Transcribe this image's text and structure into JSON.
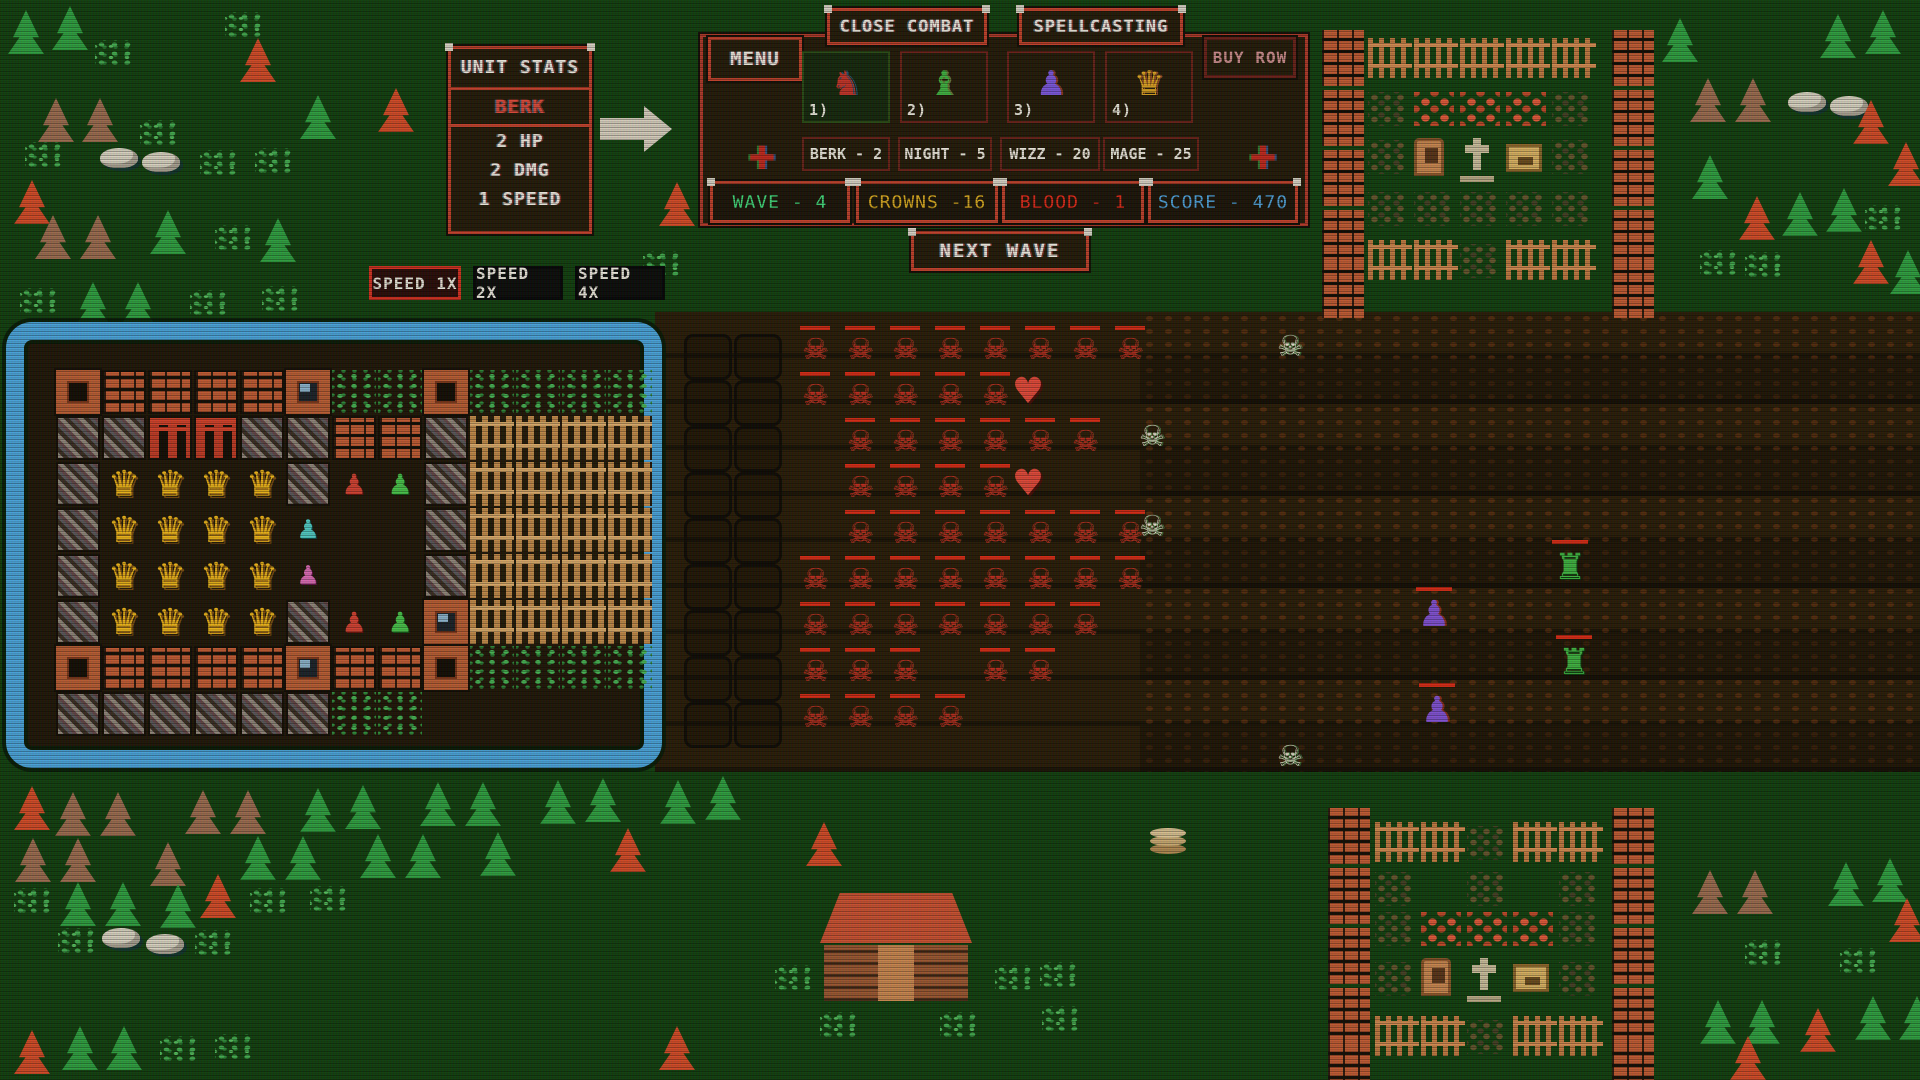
{
  "hud": {
    "unit_stats": {
      "title": "UNIT STATS",
      "unit_name": "BERK",
      "lines": [
        "2 HP",
        "2 DMG",
        "1 SPEED"
      ]
    },
    "menu_label": "MENU",
    "close_combat_label": "CLOSE COMBAT",
    "spellcasting_label": "SPELLCASTING",
    "buy_row_label": "BUY ROW",
    "slots": [
      {
        "num": "1)",
        "unit": "berk",
        "glyph": "♞"
      },
      {
        "num": "2)",
        "unit": "night",
        "glyph": "♝"
      },
      {
        "num": "3)",
        "unit": "wizz",
        "glyph": "♟"
      },
      {
        "num": "4)",
        "unit": "mage",
        "glyph": "♛"
      }
    ],
    "costs": [
      "BERK - 2",
      "NIGHT - 5",
      "WIZZ - 20",
      "MAGE - 25"
    ],
    "stats": [
      {
        "label": "WAVE - 4",
        "color": "#42d87a"
      },
      {
        "label": "CROWNS -16",
        "color": "#d8a81f"
      },
      {
        "label": "BLOOD - 1",
        "color": "#e02818"
      },
      {
        "label": "SCORE - 470",
        "color": "#4fa0d8"
      }
    ],
    "next_wave_label": "NEXT WAVE",
    "speed_buttons": [
      {
        "label": "SPEED 1X",
        "active": true
      },
      {
        "label": "SPEED 2X",
        "active": false
      },
      {
        "label": "SPEED 4X",
        "active": false
      }
    ],
    "deco_cross": "✚"
  },
  "colors": {
    "accent_red": "#c0402a",
    "fort_blue": "#4aa2d8",
    "bg_green": "#123f0e",
    "field_brown": "#241906"
  },
  "sprite_glyphs": {
    "skel-red": "☠",
    "skel-white": "☠",
    "heart": "♥",
    "robot": "♜",
    "octo": "♟"
  },
  "fort_glyphs": {
    "C": "♛",
    "r": "♟",
    "n": "♟",
    "c": "♟",
    "p": "♟"
  },
  "map": {
    "fort": {
      "x0": 38,
      "y0": 352,
      "cell": 46,
      "rows": [
        "TWWWWSggTgggg",
        "MMGGMMWWMFFFF",
        "MCCCCMrnMFFFF",
        "MCCCCc..MFFFF",
        "MCCCCp..MFFFF",
        "MCCCCMrnSFFFF",
        "TWWWWSWWTgggg",
        "MMMMMMgg....."
      ]
    },
    "grids": [
      {
        "t": "slotcell",
        "x0": 684,
        "y0": 334,
        "dx": 50,
        "dy": 46,
        "rows": [
          "11",
          "11",
          "11",
          "11",
          "11",
          "11",
          "11",
          "11",
          "11"
        ]
      },
      {
        "t": "skel-red",
        "x0": 795,
        "y0": 328,
        "dx": 45,
        "dy": 46,
        "rows": [
          "11111111",
          "11111000",
          "01111110",
          "01111000",
          "01111111",
          "11111111",
          "11111110",
          "11101100",
          "11110000"
        ]
      }
    ],
    "sprites": [
      {
        "t": "tree-green",
        "x": 8,
        "y": 10
      },
      {
        "t": "tree-green",
        "x": 52,
        "y": 6
      },
      {
        "t": "grass",
        "x": 95,
        "y": 40
      },
      {
        "t": "grass",
        "x": 225,
        "y": 12
      },
      {
        "t": "tree-red",
        "x": 240,
        "y": 38
      },
      {
        "t": "tree-brown",
        "x": 38,
        "y": 98
      },
      {
        "t": "tree-brown",
        "x": 82,
        "y": 98
      },
      {
        "t": "grass",
        "x": 140,
        "y": 120
      },
      {
        "t": "grass",
        "x": 25,
        "y": 142
      },
      {
        "t": "rock",
        "x": 100,
        "y": 148
      },
      {
        "t": "rock",
        "x": 142,
        "y": 152
      },
      {
        "t": "grass",
        "x": 200,
        "y": 150
      },
      {
        "t": "grass",
        "x": 255,
        "y": 148
      },
      {
        "t": "tree-red",
        "x": 378,
        "y": 88
      },
      {
        "t": "tree-green",
        "x": 300,
        "y": 95
      },
      {
        "t": "tree-red",
        "x": 14,
        "y": 180
      },
      {
        "t": "tree-brown",
        "x": 35,
        "y": 215
      },
      {
        "t": "tree-brown",
        "x": 80,
        "y": 215
      },
      {
        "t": "tree-green",
        "x": 150,
        "y": 210
      },
      {
        "t": "grass",
        "x": 215,
        "y": 225
      },
      {
        "t": "tree-green",
        "x": 260,
        "y": 218
      },
      {
        "t": "grass",
        "x": 20,
        "y": 288
      },
      {
        "t": "tree-green",
        "x": 75,
        "y": 282
      },
      {
        "t": "tree-green",
        "x": 120,
        "y": 282
      },
      {
        "t": "grass",
        "x": 190,
        "y": 290
      },
      {
        "t": "grass",
        "x": 262,
        "y": 286
      },
      {
        "t": "tree-red",
        "x": 659,
        "y": 182
      },
      {
        "t": "grass",
        "x": 643,
        "y": 251
      },
      {
        "t": "tree-green",
        "x": 1662,
        "y": 18
      },
      {
        "t": "tree-green",
        "x": 1820,
        "y": 14
      },
      {
        "t": "tree-green",
        "x": 1865,
        "y": 10
      },
      {
        "t": "tree-brown",
        "x": 1690,
        "y": 78
      },
      {
        "t": "tree-brown",
        "x": 1735,
        "y": 78
      },
      {
        "t": "rock",
        "x": 1788,
        "y": 92
      },
      {
        "t": "rock",
        "x": 1830,
        "y": 96
      },
      {
        "t": "tree-red",
        "x": 1853,
        "y": 100
      },
      {
        "t": "tree-green",
        "x": 1692,
        "y": 155
      },
      {
        "t": "tree-red",
        "x": 1888,
        "y": 142
      },
      {
        "t": "tree-red",
        "x": 1739,
        "y": 196
      },
      {
        "t": "tree-green",
        "x": 1782,
        "y": 192
      },
      {
        "t": "tree-green",
        "x": 1826,
        "y": 188
      },
      {
        "t": "tree-red",
        "x": 1853,
        "y": 240
      },
      {
        "t": "grass",
        "x": 1700,
        "y": 250
      },
      {
        "t": "grass",
        "x": 1745,
        "y": 252
      },
      {
        "t": "grass",
        "x": 1865,
        "y": 205
      },
      {
        "t": "tree-green",
        "x": 1890,
        "y": 250
      },
      {
        "t": "brickcol",
        "x": 1322,
        "y": 30
      },
      {
        "t": "brickcol",
        "x": 1322,
        "y": 90
      },
      {
        "t": "brickcol",
        "x": 1322,
        "y": 150
      },
      {
        "t": "brickcol",
        "x": 1322,
        "y": 210
      },
      {
        "t": "brickcol",
        "x": 1322,
        "y": 262
      },
      {
        "t": "brickcol",
        "x": 1612,
        "y": 30
      },
      {
        "t": "brickcol",
        "x": 1612,
        "y": 90
      },
      {
        "t": "brickcol",
        "x": 1612,
        "y": 150
      },
      {
        "t": "brickcol",
        "x": 1612,
        "y": 210
      },
      {
        "t": "brickcol",
        "x": 1612,
        "y": 262
      },
      {
        "t": "fence",
        "x": 1368,
        "y": 38
      },
      {
        "t": "fence",
        "x": 1414,
        "y": 38
      },
      {
        "t": "fence",
        "x": 1460,
        "y": 38
      },
      {
        "t": "fence",
        "x": 1506,
        "y": 38
      },
      {
        "t": "fence",
        "x": 1552,
        "y": 38
      },
      {
        "t": "dirt",
        "x": 1368,
        "y": 92
      },
      {
        "t": "flowers",
        "x": 1414,
        "y": 92
      },
      {
        "t": "flowers",
        "x": 1460,
        "y": 92
      },
      {
        "t": "flowers",
        "x": 1506,
        "y": 92
      },
      {
        "t": "dirt",
        "x": 1552,
        "y": 92
      },
      {
        "t": "dirt",
        "x": 1368,
        "y": 140
      },
      {
        "t": "door",
        "x": 1414,
        "y": 138
      },
      {
        "t": "gravecross",
        "x": 1460,
        "y": 136
      },
      {
        "t": "chest",
        "x": 1506,
        "y": 144
      },
      {
        "t": "dirt",
        "x": 1552,
        "y": 140
      },
      {
        "t": "dirt",
        "x": 1368,
        "y": 192
      },
      {
        "t": "dirt",
        "x": 1414,
        "y": 192
      },
      {
        "t": "dirt",
        "x": 1460,
        "y": 192
      },
      {
        "t": "dirt",
        "x": 1506,
        "y": 192
      },
      {
        "t": "dirt",
        "x": 1552,
        "y": 192
      },
      {
        "t": "fence",
        "x": 1368,
        "y": 240
      },
      {
        "t": "fence",
        "x": 1414,
        "y": 240
      },
      {
        "t": "dirt",
        "x": 1460,
        "y": 244
      },
      {
        "t": "fence",
        "x": 1506,
        "y": 240
      },
      {
        "t": "fence",
        "x": 1552,
        "y": 240
      },
      {
        "t": "skel-white",
        "x": 1270,
        "y": 325
      },
      {
        "t": "skel-white",
        "x": 1132,
        "y": 415
      },
      {
        "t": "skel-white",
        "x": 1132,
        "y": 505
      },
      {
        "t": "skel-white",
        "x": 1270,
        "y": 735
      },
      {
        "t": "heart",
        "x": 1008,
        "y": 370
      },
      {
        "t": "heart",
        "x": 1008,
        "y": 462
      },
      {
        "t": "robot",
        "x": 1548,
        "y": 545
      },
      {
        "t": "robot",
        "x": 1552,
        "y": 640
      },
      {
        "t": "octo",
        "x": 1412,
        "y": 592
      },
      {
        "t": "octo",
        "x": 1415,
        "y": 688
      },
      {
        "t": "tree-red",
        "x": 14,
        "y": 786
      },
      {
        "t": "tree-brown",
        "x": 55,
        "y": 792
      },
      {
        "t": "tree-brown",
        "x": 100,
        "y": 792
      },
      {
        "t": "tree-brown",
        "x": 185,
        "y": 790
      },
      {
        "t": "tree-brown",
        "x": 230,
        "y": 790
      },
      {
        "t": "tree-green",
        "x": 300,
        "y": 788
      },
      {
        "t": "tree-green",
        "x": 345,
        "y": 785
      },
      {
        "t": "tree-green",
        "x": 420,
        "y": 782
      },
      {
        "t": "tree-green",
        "x": 465,
        "y": 782
      },
      {
        "t": "tree-green",
        "x": 540,
        "y": 780
      },
      {
        "t": "tree-green",
        "x": 585,
        "y": 778
      },
      {
        "t": "tree-green",
        "x": 660,
        "y": 780
      },
      {
        "t": "tree-green",
        "x": 705,
        "y": 776
      },
      {
        "t": "tree-brown",
        "x": 15,
        "y": 838
      },
      {
        "t": "tree-brown",
        "x": 60,
        "y": 838
      },
      {
        "t": "tree-brown",
        "x": 150,
        "y": 842
      },
      {
        "t": "tree-green",
        "x": 240,
        "y": 836
      },
      {
        "t": "tree-green",
        "x": 285,
        "y": 836
      },
      {
        "t": "tree-green",
        "x": 360,
        "y": 834
      },
      {
        "t": "tree-green",
        "x": 405,
        "y": 834
      },
      {
        "t": "tree-green",
        "x": 480,
        "y": 832
      },
      {
        "t": "tree-red",
        "x": 610,
        "y": 828
      },
      {
        "t": "tree-red",
        "x": 806,
        "y": 822
      },
      {
        "t": "grass",
        "x": 14,
        "y": 888
      },
      {
        "t": "tree-green",
        "x": 60,
        "y": 882
      },
      {
        "t": "tree-green",
        "x": 105,
        "y": 882
      },
      {
        "t": "tree-green",
        "x": 160,
        "y": 884
      },
      {
        "t": "tree-red",
        "x": 200,
        "y": 874
      },
      {
        "t": "grass",
        "x": 250,
        "y": 888
      },
      {
        "t": "grass",
        "x": 310,
        "y": 886
      },
      {
        "t": "grass",
        "x": 58,
        "y": 928
      },
      {
        "t": "rock",
        "x": 102,
        "y": 928
      },
      {
        "t": "rock",
        "x": 146,
        "y": 934
      },
      {
        "t": "grass",
        "x": 195,
        "y": 930
      },
      {
        "t": "tree-red",
        "x": 14,
        "y": 1030
      },
      {
        "t": "tree-green",
        "x": 62,
        "y": 1026
      },
      {
        "t": "tree-green",
        "x": 106,
        "y": 1026
      },
      {
        "t": "grass",
        "x": 160,
        "y": 1036
      },
      {
        "t": "grass",
        "x": 215,
        "y": 1034
      },
      {
        "t": "tree-red",
        "x": 659,
        "y": 1026
      },
      {
        "t": "house",
        "x": 820,
        "y": 893
      },
      {
        "t": "grass",
        "x": 775,
        "y": 965
      },
      {
        "t": "grass",
        "x": 995,
        "y": 965
      },
      {
        "t": "grass",
        "x": 1040,
        "y": 962
      },
      {
        "t": "grass",
        "x": 1042,
        "y": 1006
      },
      {
        "t": "grass",
        "x": 820,
        "y": 1012
      },
      {
        "t": "grass",
        "x": 940,
        "y": 1012
      },
      {
        "t": "stack",
        "x": 1150,
        "y": 828
      },
      {
        "t": "brickcol",
        "x": 1328,
        "y": 808
      },
      {
        "t": "brickcol",
        "x": 1328,
        "y": 868
      },
      {
        "t": "brickcol",
        "x": 1328,
        "y": 928
      },
      {
        "t": "brickcol",
        "x": 1328,
        "y": 988
      },
      {
        "t": "brickcol",
        "x": 1328,
        "y": 1044
      },
      {
        "t": "brickcol",
        "x": 1612,
        "y": 808
      },
      {
        "t": "brickcol",
        "x": 1612,
        "y": 868
      },
      {
        "t": "brickcol",
        "x": 1612,
        "y": 928
      },
      {
        "t": "brickcol",
        "x": 1612,
        "y": 988
      },
      {
        "t": "brickcol",
        "x": 1612,
        "y": 1044
      },
      {
        "t": "fence",
        "x": 1375,
        "y": 822
      },
      {
        "t": "fence",
        "x": 1421,
        "y": 822
      },
      {
        "t": "dirt",
        "x": 1467,
        "y": 826
      },
      {
        "t": "fence",
        "x": 1513,
        "y": 822
      },
      {
        "t": "fence",
        "x": 1559,
        "y": 822
      },
      {
        "t": "dirt",
        "x": 1375,
        "y": 872
      },
      {
        "t": "dirt",
        "x": 1467,
        "y": 872
      },
      {
        "t": "dirt",
        "x": 1559,
        "y": 872
      },
      {
        "t": "dirt",
        "x": 1375,
        "y": 912
      },
      {
        "t": "flowers",
        "x": 1421,
        "y": 912
      },
      {
        "t": "flowers",
        "x": 1467,
        "y": 912
      },
      {
        "t": "flowers",
        "x": 1513,
        "y": 912
      },
      {
        "t": "dirt",
        "x": 1559,
        "y": 912
      },
      {
        "t": "dirt",
        "x": 1375,
        "y": 962
      },
      {
        "t": "door",
        "x": 1421,
        "y": 958
      },
      {
        "t": "gravecross",
        "x": 1467,
        "y": 956
      },
      {
        "t": "chest",
        "x": 1513,
        "y": 964
      },
      {
        "t": "dirt",
        "x": 1559,
        "y": 962
      },
      {
        "t": "fence",
        "x": 1375,
        "y": 1016
      },
      {
        "t": "fence",
        "x": 1421,
        "y": 1016
      },
      {
        "t": "dirt",
        "x": 1467,
        "y": 1020
      },
      {
        "t": "fence",
        "x": 1513,
        "y": 1016
      },
      {
        "t": "fence",
        "x": 1559,
        "y": 1016
      },
      {
        "t": "tree-brown",
        "x": 1692,
        "y": 870
      },
      {
        "t": "tree-brown",
        "x": 1737,
        "y": 870
      },
      {
        "t": "tree-green",
        "x": 1828,
        "y": 862
      },
      {
        "t": "tree-green",
        "x": 1872,
        "y": 858
      },
      {
        "t": "tree-red",
        "x": 1889,
        "y": 898
      },
      {
        "t": "grass",
        "x": 1745,
        "y": 940
      },
      {
        "t": "grass",
        "x": 1840,
        "y": 948
      },
      {
        "t": "tree-green",
        "x": 1700,
        "y": 1000
      },
      {
        "t": "tree-green",
        "x": 1744,
        "y": 1000
      },
      {
        "t": "tree-red",
        "x": 1800,
        "y": 1008
      },
      {
        "t": "tree-green",
        "x": 1855,
        "y": 996
      },
      {
        "t": "tree-green",
        "x": 1899,
        "y": 996
      },
      {
        "t": "tree-red",
        "x": 1730,
        "y": 1036
      }
    ]
  }
}
